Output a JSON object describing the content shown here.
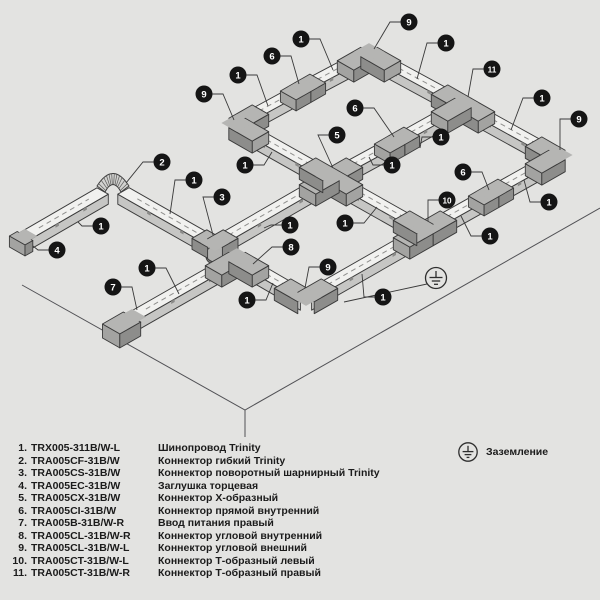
{
  "canvas": {
    "width": 600,
    "height": 600,
    "background": "#e3e3e1"
  },
  "diagram": {
    "colors": {
      "rail_top": "#f1f1ef",
      "rail_front": "#c6c6c4",
      "connector_top": "#b5b5b3",
      "connector_front": "#8d8d8b",
      "connector_end": "#a3a3a1",
      "outline": "#3a3a3a",
      "dash": "#8f8f8d",
      "leader": "#3a3a3a",
      "floor_line": "#515155",
      "callout_fill": "#151515",
      "callout_text": "#ffffff",
      "ground_stroke": "#2e2e2e"
    },
    "floor": {
      "polyline": [
        [
          22,
          285
        ],
        [
          245,
          410
        ],
        [
          600,
          208
        ]
      ],
      "drop": [
        [
          245,
          410
        ],
        [
          245,
          437
        ]
      ]
    },
    "nodes": {
      "endL": [
        25,
        236
      ],
      "flex": [
        113,
        185
      ],
      "swivel": [
        215,
        243
      ],
      "X": [
        331,
        176
      ],
      "W": [
        237,
        123
      ],
      "C6a": [
        303,
        87
      ],
      "N": [
        369,
        52
      ],
      "T11": [
        463,
        103
      ],
      "E": [
        557,
        155
      ],
      "C6b": [
        397,
        140
      ],
      "C6c": [
        491,
        192
      ],
      "T10": [
        425,
        229
      ],
      "bot9": [
        306,
        297
      ],
      "c8": [
        237,
        257
      ],
      "feed": [
        132,
        317
      ]
    },
    "segments": [
      [
        "endL",
        "flex"
      ],
      [
        "flex",
        "swivel"
      ],
      [
        "swivel",
        "X"
      ],
      [
        "W",
        "C6a"
      ],
      [
        "C6a",
        "N"
      ],
      [
        "N",
        "T11"
      ],
      [
        "T11",
        "E"
      ],
      [
        "W",
        "X"
      ],
      [
        "X",
        "T10"
      ],
      [
        "X",
        "C6b"
      ],
      [
        "C6b",
        "T11"
      ],
      [
        "E",
        "C6c"
      ],
      [
        "C6c",
        "T10"
      ],
      [
        "feed",
        "c8"
      ],
      [
        "c8",
        "bot9"
      ],
      [
        "bot9",
        "T10"
      ]
    ],
    "connectors": [
      {
        "type": "corner",
        "node": "N",
        "arms": [
          "SW",
          "SE"
        ],
        "ref": "9"
      },
      {
        "type": "corner",
        "node": "W",
        "arms": [
          "NE",
          "SE"
        ],
        "ref": "9"
      },
      {
        "type": "corner",
        "node": "E",
        "arms": [
          "NW",
          "SW"
        ],
        "ref": "9"
      },
      {
        "type": "corner",
        "node": "bot9",
        "arms": [
          "NW",
          "NE"
        ],
        "ref": "9"
      },
      {
        "type": "corner",
        "node": "c8",
        "arms": [
          "SW",
          "SE"
        ],
        "ref": "8"
      },
      {
        "type": "tee",
        "node": "T11",
        "arms": [
          "NW",
          "SE",
          "SW"
        ],
        "ref": "11"
      },
      {
        "type": "tee",
        "node": "T10",
        "arms": [
          "SW",
          "NE",
          "NW"
        ],
        "ref": "10"
      },
      {
        "type": "cross",
        "node": "X",
        "arms": [
          "NE",
          "SE",
          "SW",
          "NW"
        ],
        "ref": "5"
      },
      {
        "type": "straight",
        "node": "C6a",
        "arms": [
          "NE",
          "SW"
        ],
        "ref": "6"
      },
      {
        "type": "straight",
        "node": "C6b",
        "arms": [
          "NE",
          "SW"
        ],
        "ref": "6"
      },
      {
        "type": "straight",
        "node": "C6c",
        "arms": [
          "NE",
          "SW"
        ],
        "ref": "6"
      },
      {
        "type": "flex",
        "node": "flex",
        "arms": [
          "SW",
          "SE"
        ],
        "ref": "2"
      },
      {
        "type": "swivel",
        "node": "swivel",
        "arms": [
          "NW",
          "NE"
        ],
        "ref": "3"
      },
      {
        "type": "endcap",
        "node": "endL",
        "arms": [
          "SW"
        ],
        "ref": "4"
      },
      {
        "type": "feed",
        "node": "feed",
        "arms": [
          "SW"
        ],
        "ref": "7"
      }
    ],
    "callouts": [
      {
        "num": "9",
        "x": 409,
        "y": 22,
        "tx": 374,
        "ty": 49
      },
      {
        "num": "1",
        "x": 301,
        "y": 39,
        "tx": 333,
        "ty": 70
      },
      {
        "num": "1",
        "x": 446,
        "y": 43,
        "tx": 417,
        "ty": 79
      },
      {
        "num": "6",
        "x": 272,
        "y": 56,
        "tx": 299,
        "ty": 84
      },
      {
        "num": "11",
        "x": 492,
        "y": 69,
        "tx": 468,
        "ty": 97
      },
      {
        "num": "1",
        "x": 238,
        "y": 75,
        "tx": 268,
        "ty": 106
      },
      {
        "num": "9",
        "x": 204,
        "y": 94,
        "tx": 234,
        "ty": 120
      },
      {
        "num": "1",
        "x": 542,
        "y": 98,
        "tx": 511,
        "ty": 130
      },
      {
        "num": "6",
        "x": 355,
        "y": 108,
        "tx": 394,
        "ty": 137
      },
      {
        "num": "9",
        "x": 579,
        "y": 119,
        "tx": 560,
        "ty": 150
      },
      {
        "num": "5",
        "x": 337,
        "y": 135,
        "tx": 333,
        "ty": 168
      },
      {
        "num": "1",
        "x": 441,
        "y": 137,
        "tx": 420,
        "ty": 148
      },
      {
        "num": "1",
        "x": 245,
        "y": 165,
        "tx": 272,
        "ty": 152
      },
      {
        "num": "1",
        "x": 392,
        "y": 165,
        "tx": 369,
        "ty": 157
      },
      {
        "num": "2",
        "x": 162,
        "y": 162,
        "tx": 126,
        "ty": 183
      },
      {
        "num": "1",
        "x": 194,
        "y": 180,
        "tx": 170,
        "ty": 214
      },
      {
        "num": "6",
        "x": 463,
        "y": 172,
        "tx": 489,
        "ty": 190
      },
      {
        "num": "3",
        "x": 222,
        "y": 197,
        "tx": 213,
        "ty": 235
      },
      {
        "num": "10",
        "x": 447,
        "y": 200,
        "tx": 428,
        "ty": 221
      },
      {
        "num": "1",
        "x": 549,
        "y": 202,
        "tx": 524,
        "ty": 180
      },
      {
        "num": "1",
        "x": 101,
        "y": 226,
        "tx": 78,
        "ty": 222
      },
      {
        "num": "1",
        "x": 290,
        "y": 225,
        "tx": 264,
        "ty": 228
      },
      {
        "num": "1",
        "x": 345,
        "y": 223,
        "tx": 377,
        "ty": 207
      },
      {
        "num": "1",
        "x": 490,
        "y": 236,
        "tx": 461,
        "ty": 216
      },
      {
        "num": "4",
        "x": 57,
        "y": 250,
        "tx": 33,
        "ty": 246
      },
      {
        "num": "8",
        "x": 291,
        "y": 247,
        "tx": 253,
        "ty": 264
      },
      {
        "num": "1",
        "x": 147,
        "y": 268,
        "tx": 179,
        "ty": 294
      },
      {
        "num": "9",
        "x": 328,
        "y": 267,
        "tx": 305,
        "ty": 288
      },
      {
        "num": "7",
        "x": 113,
        "y": 287,
        "tx": 137,
        "ty": 310
      },
      {
        "num": "1",
        "x": 247,
        "y": 300,
        "tx": 273,
        "ty": 283
      },
      {
        "num": "1",
        "x": 383,
        "y": 297,
        "tx": 362,
        "ty": 274
      }
    ],
    "ground_symbol": {
      "x": 436,
      "y": 278,
      "r": 10.5,
      "leader": [
        [
          427,
          284
        ],
        [
          344,
          302
        ]
      ]
    }
  },
  "legend": {
    "items": [
      {
        "num": "1.",
        "code": "TRX005-311B/W-L",
        "desc": "Шинопровод Trinity"
      },
      {
        "num": "2.",
        "code": "TRA005CF-31B/W",
        "desc": "Коннектор гибкий Trinity"
      },
      {
        "num": "3.",
        "code": "TRA005CS-31B/W",
        "desc": "Коннектор поворотный шарнирный Trinity"
      },
      {
        "num": "4.",
        "code": "TRA005EC-31B/W",
        "desc": "Заглушка торцевая"
      },
      {
        "num": "5.",
        "code": "TRA005CX-31B/W",
        "desc": "Коннектор X-образный"
      },
      {
        "num": "6.",
        "code": "TRA005CI-31B/W",
        "desc": "Коннектор прямой внутренний"
      },
      {
        "num": "7.",
        "code": "TRA005B-31B/W-R",
        "desc": "Ввод питания правый"
      },
      {
        "num": "8.",
        "code": "TRA005CL-31B/W-R",
        "desc": "Коннектор угловой внутренний"
      },
      {
        "num": "9.",
        "code": "TRA005CL-31B/W-L",
        "desc": "Коннектор угловой внешний"
      },
      {
        "num": "10.",
        "code": "TRA005CT-31B/W-L",
        "desc": "Коннектор Т-образный левый"
      },
      {
        "num": "11.",
        "code": "TRA005CT-31B/W-R",
        "desc": "Коннектор Т-образный правый"
      }
    ],
    "grounding": {
      "label": "Заземление"
    }
  }
}
